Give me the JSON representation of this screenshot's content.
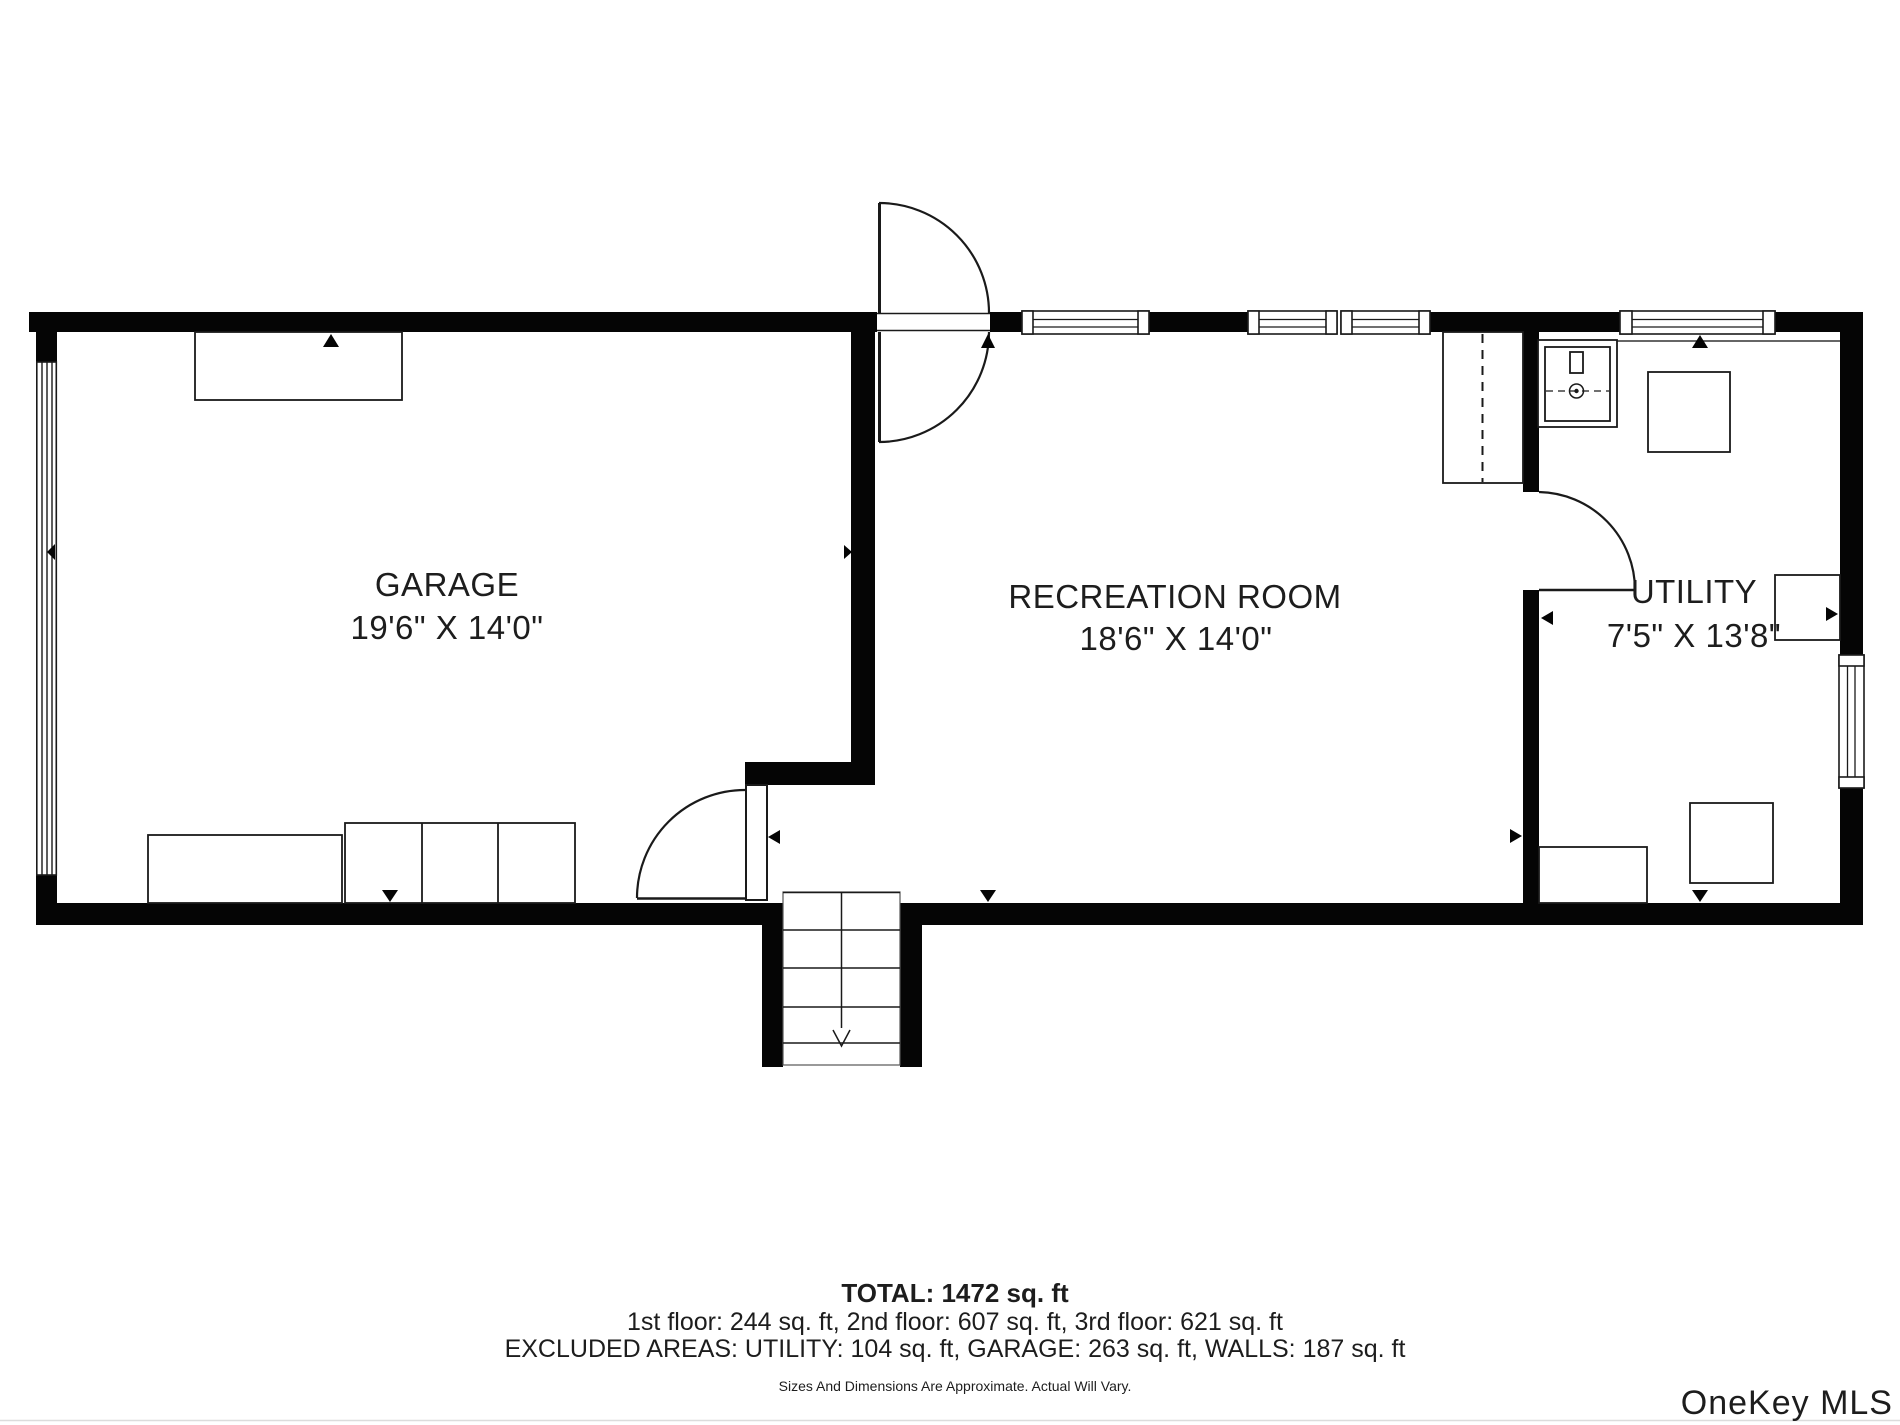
{
  "plan": {
    "rooms": [
      {
        "id": "garage",
        "name": "GARAGE",
        "dimensions": "19'6\" X 14'0\""
      },
      {
        "id": "recreation-room",
        "name": "RECREATION ROOM",
        "dimensions": "18'6\" X 14'0\""
      },
      {
        "id": "utility",
        "name": "UTILITY",
        "dimensions": "7'5\" X 13'8\""
      }
    ]
  },
  "summary": {
    "total": "TOTAL: 1472 sq. ft",
    "floors": "1st floor: 244 sq. ft, 2nd floor: 607 sq. ft, 3rd floor: 621 sq. ft",
    "excluded_areas": "EXCLUDED AREAS: UTILITY: 104 sq. ft, GARAGE: 263 sq. ft, WALLS: 187 sq. ft",
    "disclaimer": "Sizes And Dimensions Are Approximate. Actual Will Vary."
  },
  "watermark": {
    "text": "OneKey MLS",
    "color": "#a9a9a9"
  },
  "colors": {
    "wall": "#050505",
    "line": "#1a1a1a",
    "text": "#1d1d1d"
  }
}
